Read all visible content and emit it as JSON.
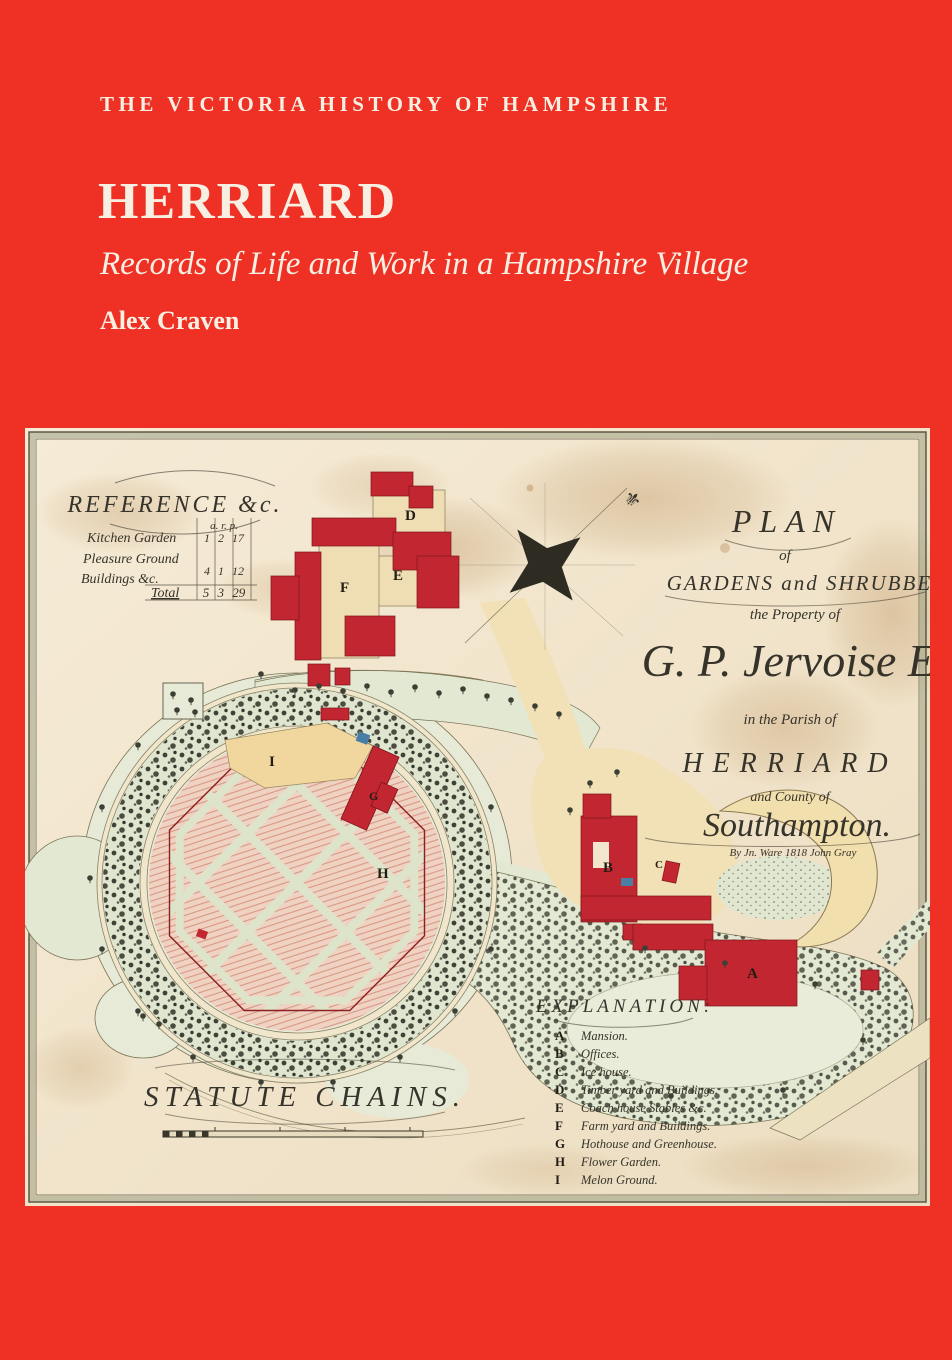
{
  "cover": {
    "series_title": "THE VICTORIA HISTORY OF HAMPSHIRE",
    "title": "HERRIARD",
    "subtitle": "Records of Life and Work in a Hampshire Village",
    "author": "Alex Craven"
  },
  "icons": {
    "north_pointer": "⚜"
  },
  "colors": {
    "cover_red": "#ee3124",
    "cover_text": "#f8efe3",
    "paper": "#f2e6cf",
    "building_red": "#c22630",
    "garden_pink": "#f0d2c3",
    "foliage_green": "#e3e8d2",
    "ink": "#36332a",
    "water_blue": "#4a7fa5"
  },
  "map": {
    "reference": {
      "heading": "REFERENCE &c.",
      "columns": "a. r. p.",
      "rows": [
        {
          "label": "Kitchen Garden",
          "value": "1 2 17"
        },
        {
          "label": "Pleasure Ground",
          "value": ""
        },
        {
          "label": "Buildings &c.",
          "value": "4 1 12"
        },
        {
          "label": "Total",
          "value": "5 3 29"
        }
      ]
    },
    "title_block": {
      "lines": [
        "PLAN",
        "of",
        "GARDENS and SHRUBBERIES",
        "the Property of",
        "G. P. Jervoise Esq.",
        "in the Parish of",
        "HERRIARD",
        "and County of",
        "Southampton.",
        "By Jn. Ware 1818   John Gray"
      ]
    },
    "explanation": {
      "heading": "EXPLANATION:",
      "items": [
        {
          "letter": "A",
          "label": "Mansion."
        },
        {
          "letter": "B",
          "label": "Offices."
        },
        {
          "letter": "C",
          "label": "Ice house."
        },
        {
          "letter": "D",
          "label": "Timber yard and Buildings."
        },
        {
          "letter": "E",
          "label": "Coach house Stables &c."
        },
        {
          "letter": "F",
          "label": "Farm yard and Buildings."
        },
        {
          "letter": "G",
          "label": "Hothouse and Greenhouse."
        },
        {
          "letter": "H",
          "label": "Flower Garden."
        },
        {
          "letter": "I",
          "label": "Melon Ground."
        }
      ]
    },
    "scale_label": "STATUTE CHAINS."
  }
}
